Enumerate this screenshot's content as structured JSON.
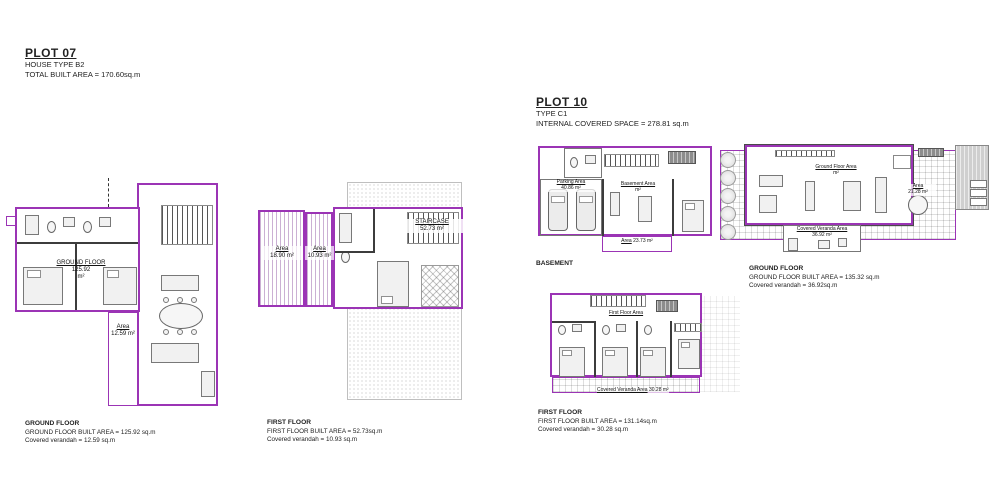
{
  "colors": {
    "outline": "#9b34b5",
    "wall": "#3c3c3c"
  },
  "plot07": {
    "title": "PLOT 07",
    "subtitle1": "HOUSE TYPE B2",
    "subtitle2": "TOTAL BUILT AREA = 170.60sq.m",
    "ground": {
      "room_label": "GROUND FLOOR",
      "room_area": "125.92",
      "room_unit": "m²",
      "veranda_label": "Area",
      "veranda_area": "12.59 m²",
      "caption_title": "GROUND FLOOR",
      "caption_line1": "GROUND FLOOR BUILT AREA = 125.92 sq.m",
      "caption_line2": "Covered verandah = 12.59 sq.m"
    },
    "first": {
      "veranda1_label": "Area",
      "veranda1_area": "18.90 m²",
      "veranda2_label": "Area",
      "veranda2_area": "10.93 m²",
      "staircase_label": "STAIRCASE",
      "staircase_area": "52.73 m²",
      "caption_title": "FIRST FLOOR",
      "caption_line1": "FIRST FLOOR BUILT AREA = 52.73sq.m",
      "caption_line2": "Covered verandah = 10.93 sq.m"
    }
  },
  "plot10": {
    "title": "PLOT 10",
    "subtitle1": "TYPE C1",
    "subtitle2": "INTERNAL COVERED SPACE = 278.81 sq.m",
    "basement": {
      "caption_title": "BASEMENT",
      "parking_label": "Parking Area",
      "parking_area": "40.86 m²",
      "room_label": "Basement Area",
      "room_unit": "m²",
      "bottom_label": "Area",
      "bottom_area": "23.73 m²"
    },
    "ground": {
      "room_label": "Ground Floor Area",
      "room_unit": "m²",
      "veranda_label": "Covered Veranda Area",
      "veranda_area": "36.92 m²",
      "terrace_label": "Area",
      "terrace_area": "21.28 m²",
      "caption_title": "GROUND FLOOR",
      "caption_line1": "GROUND FLOOR BUILT AREA = 135.32 sq.m",
      "caption_line2": "Covered verandah = 36.92sq.m"
    },
    "first": {
      "room_label": "First Floor Area",
      "veranda_label": "Covered Veranda Area",
      "veranda_area": "30.28 m²",
      "caption_title": "FIRST FLOOR",
      "caption_line1": "FIRST FLOOR BUILT AREA = 131.14sq.m",
      "caption_line2": "Covered verandah = 30.28 sq.m"
    }
  }
}
